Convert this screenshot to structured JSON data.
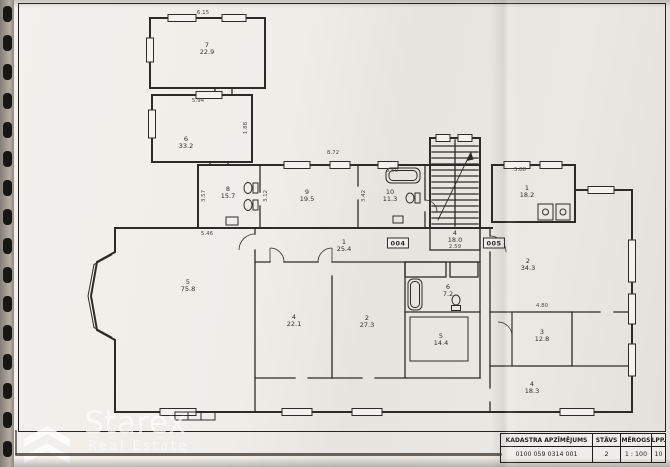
{
  "plan": {
    "rooms": [
      {
        "n": "7",
        "a": "22.9"
      },
      {
        "n": "6",
        "a": "33.2"
      },
      {
        "n": "8",
        "a": "15.7"
      },
      {
        "n": "9",
        "a": "19.5"
      },
      {
        "n": "10",
        "a": "11.3"
      },
      {
        "n": "4",
        "a": "18.0"
      },
      {
        "n": "1",
        "a": "25.4"
      },
      {
        "n": "5",
        "a": "75.8"
      },
      {
        "n": "6",
        "a": "7.2"
      },
      {
        "n": "4",
        "a": "22.1"
      },
      {
        "n": "2",
        "a": "27.3"
      },
      {
        "n": "5",
        "a": "14.4"
      },
      {
        "n": "1",
        "a": "18.2"
      },
      {
        "n": "2",
        "a": "34.3"
      },
      {
        "n": "3",
        "a": "12.8"
      },
      {
        "n": "4",
        "a": "18.3"
      }
    ],
    "unit_plates": [
      {
        "label": "004"
      },
      {
        "label": "005"
      }
    ],
    "dimensions": [
      "6.15",
      "5.94",
      "8.72",
      "3.57",
      "3.12",
      "3.50",
      "3.42",
      "5.46",
      "2.59",
      "5.88",
      "1.88",
      "4.80"
    ]
  },
  "title_block": {
    "headers": [
      "KADASTRA APZĪMĒJUMS",
      "STĀVS",
      "MĒROGS",
      "LPP."
    ],
    "values": [
      "0100 059 0314 001",
      "2",
      "1 : 100",
      "10"
    ]
  },
  "watermark": {
    "brand": "Starex",
    "tagline": "Real Estate"
  }
}
